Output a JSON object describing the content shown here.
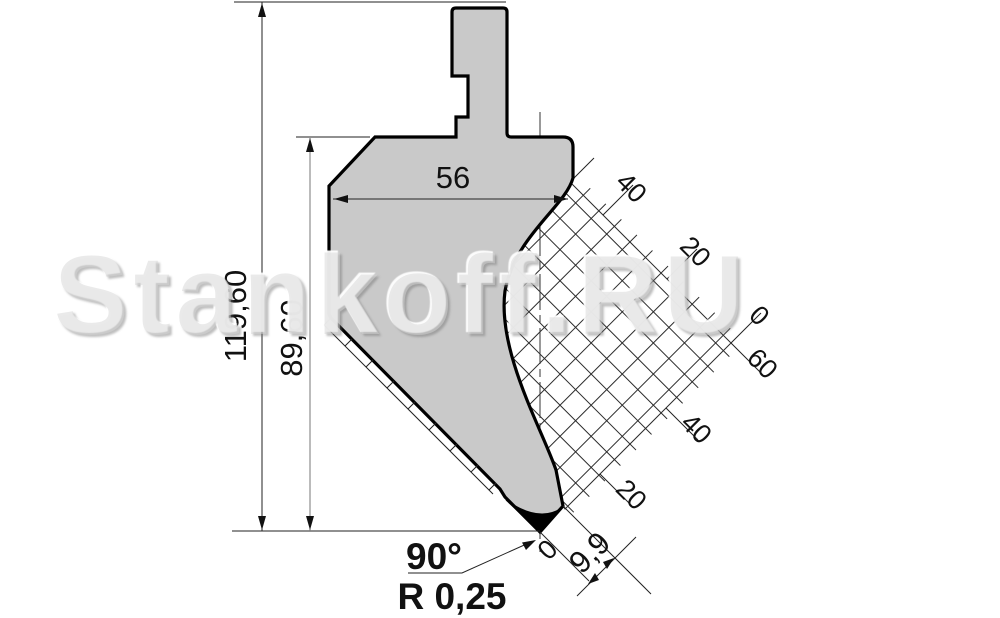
{
  "watermark": {
    "text": "Stankoff.RU"
  },
  "drawing": {
    "type": "press-brake punch profile, dimensioned technical drawing",
    "dims": {
      "total_height": "119,60",
      "working_height": "89,60",
      "body_width": "56",
      "tip_angle": "90°",
      "tip_radius": "R 0,25",
      "tip_offset": "9,9",
      "tip_zero": "0"
    },
    "grid": {
      "upper_scale": [
        "40",
        "20",
        "0"
      ],
      "lower_scale": [
        "60",
        "40",
        "20"
      ]
    },
    "colors": {
      "body_fill": "#c9c9c9",
      "outline": "#000000",
      "hatch_line": "#2b2b2b",
      "dim_line": "#222222",
      "tip_fill": "#000000",
      "background": "#ffffff"
    }
  }
}
